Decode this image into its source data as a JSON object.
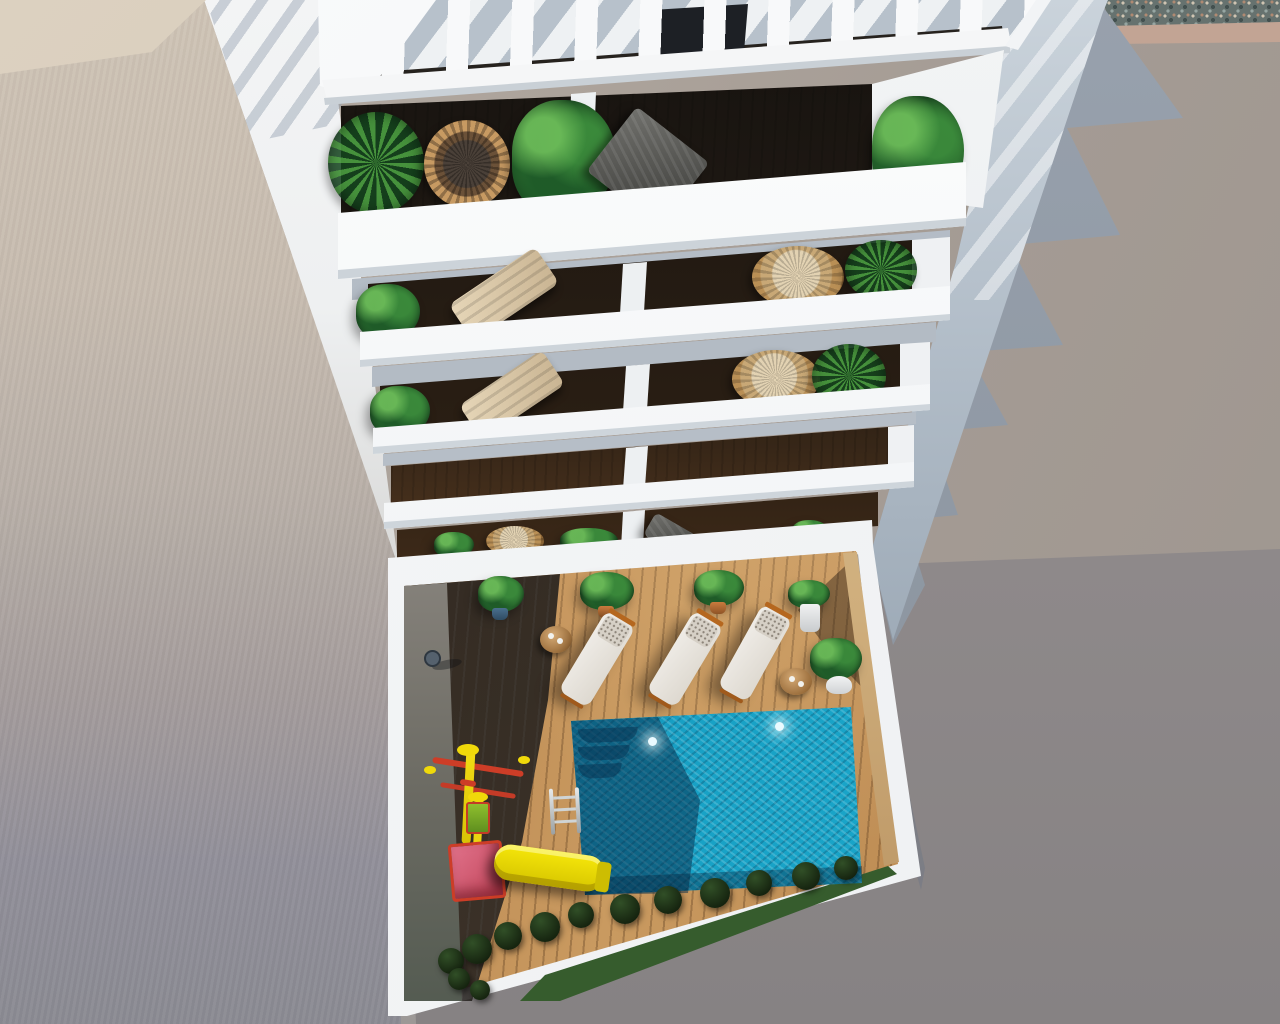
{
  "meta": {
    "domain": "Natural-Image",
    "title": "Aerial 3D architectural render of apartment building with pool courtyard",
    "description": "Top-down aerial 3D rendering of a white multi-storey residential building. The roof has a white slatted pergola. Five stacked balcony levels hold rattan chairs, beige sun chairs, dark folding loungers and green plants over dark-glass facades and wooden floors. At ground level a courtyard contains a sparkling turquoise swimming pool with steps and a ladder, three white padded sun loungers with orange frames, two round wooden side tables, potted plants, a children's playground with a yellow slide, red swing frame and pink platform, wooden decking partly in shadow, a hedge row and grass. A beige neighbouring wall borders the left; sunlit grey ground with the building's jagged cast shadow and a gravel strip lie to the right.",
    "image_width_px": 1280,
    "image_height_px": 1024,
    "visible_text": []
  },
  "palette": {
    "building_white": "#f5f6f7",
    "building_shaded_face": "#9aa7b4",
    "ground_sunlit_warm": "#aaa199",
    "ground_lower_dark": "#8d8889",
    "cast_shadow_blue_gray": "#8e97a2",
    "adjacent_wall_beige": "#c7bcb0",
    "alley_strip_light": "#f0f2f3",
    "deck_wood": "#b9854f",
    "deck_shadow": "#3a3633",
    "pool_bright": "#18a2c6",
    "pool_shadow": "#0b4a6e",
    "foliage_green": "#2e7d32",
    "wicker_tan": "#c79a62",
    "cushion_beige": "#d9c7ab",
    "lounger_white": "#eae7e1",
    "lounger_frame_orange": "#b5671f",
    "slide_yellow": "#f0d90a",
    "playground_red": "#cd3d27",
    "platform_pink": "#d4687a",
    "swing_seat_green": "#7ab52a",
    "grass_green": "#3f6b33",
    "bush_dark_green": "#1c2b16",
    "gravel_gray": "#66726f",
    "courtyard_inner_wall_tan": "#cfae7c"
  },
  "scene": {
    "background_regions": [
      {
        "name": "adjacent-roof-wall",
        "position": "left",
        "color": "#c7bcb0"
      },
      {
        "name": "sunlit-alley-strip",
        "position": "upper-left between wall and building",
        "color": "#f0f2f3"
      },
      {
        "name": "sunlit-ground",
        "position": "right",
        "color": "#aaa199"
      },
      {
        "name": "darker-ground",
        "position": "lower-right",
        "color": "#8d8889"
      },
      {
        "name": "building-cast-shadow",
        "position": "right of building, jagged sawtooth edge",
        "color": "#8e97a2"
      },
      {
        "name": "gravel-strip",
        "position": "top-right corner",
        "color": "#66726f"
      }
    ],
    "building": {
      "pergola": {
        "slat_count": 10,
        "shadow_pattern": "diagonal stripes",
        "color": "#f5f6f7"
      },
      "balcony_levels": [
        {
          "level": 1,
          "items": [
            "palm-plant",
            "round-wicker-chair",
            "banana-plant",
            "dark-folding-lounger",
            "banana-plant-right"
          ]
        },
        {
          "level": 2,
          "items": [
            "plant",
            "beige-sun-chair",
            "wicker-chair-with-cushion",
            "palm-plant"
          ]
        },
        {
          "level": 3,
          "items": [
            "plant",
            "beige-sun-chair",
            "wicker-chair-with-cushion",
            "palm-plant"
          ]
        },
        {
          "level": 4,
          "items": [
            "wooden-floor",
            "dark-glass-facade"
          ]
        },
        {
          "level": 5,
          "items": [
            "wicker-chair",
            "plants",
            "dark-chair",
            "white-planter"
          ]
        }
      ]
    },
    "courtyard": {
      "pool": {
        "color_bright": "#18a2c6",
        "color_shadow": "#0b4a6e",
        "steps": 3,
        "underwater_lights": 2,
        "ladder": 1
      },
      "sun_loungers": {
        "count": 3,
        "cushion": "#eae7e1",
        "frame": "#b5671f"
      },
      "side_tables": {
        "count": 2,
        "material": "wood"
      },
      "potted_plants": {
        "row_under_balcony": 4,
        "large_white_pot": 1
      },
      "playground": {
        "swing_frame": "yellow+red",
        "swing_seat": "green",
        "platform": "pink",
        "slide": "yellow"
      },
      "deck": {
        "material": "wood planks",
        "shadowed_side": "left"
      },
      "vegetation": {
        "hedge_bushes": 13,
        "grass_patches": 2
      },
      "wall_lamp": 1
    }
  }
}
